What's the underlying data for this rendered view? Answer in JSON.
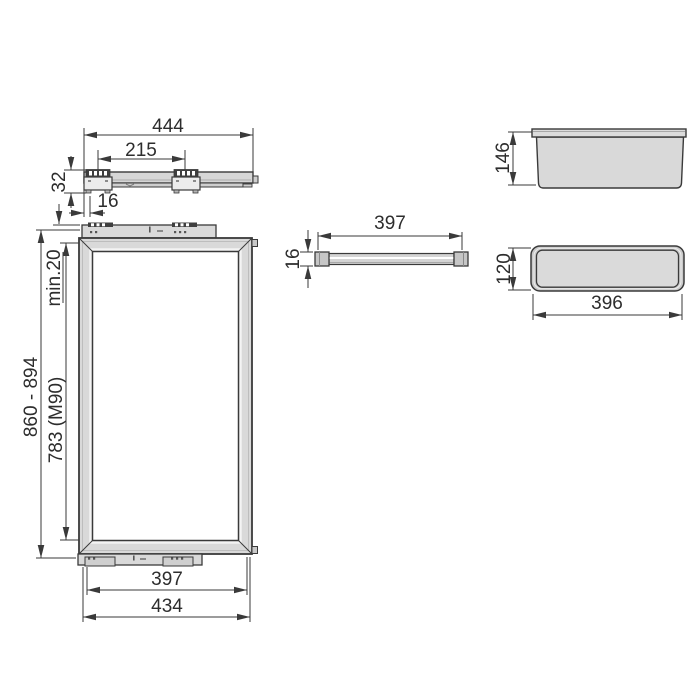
{
  "drawing": {
    "type": "technical-dimension-drawing",
    "colors": {
      "line": "#3a3a3a",
      "fill_light": "#d9d9d9",
      "fill_mid": "#c9c9c9",
      "fill_dark_detail": "#3f3f3f",
      "background": "#ffffff",
      "text": "#2d2d2d"
    },
    "views": {
      "rail_side": {
        "dim_length": "444",
        "dim_bracket_spacing": "215",
        "dim_height": "32",
        "dim_end_offset": "16"
      },
      "frame_front": {
        "dim_total_height": "860 - 894",
        "dim_frame_height": "783 (M90)",
        "dim_min_clearance": "min.20",
        "dim_inner_width": "397",
        "dim_outer_width": "434"
      },
      "bar_front": {
        "dim_length": "397",
        "dim_thickness": "16"
      },
      "basket_side": {
        "dim_height": "146"
      },
      "basket_top": {
        "dim_depth": "120",
        "dim_width": "396"
      }
    }
  }
}
